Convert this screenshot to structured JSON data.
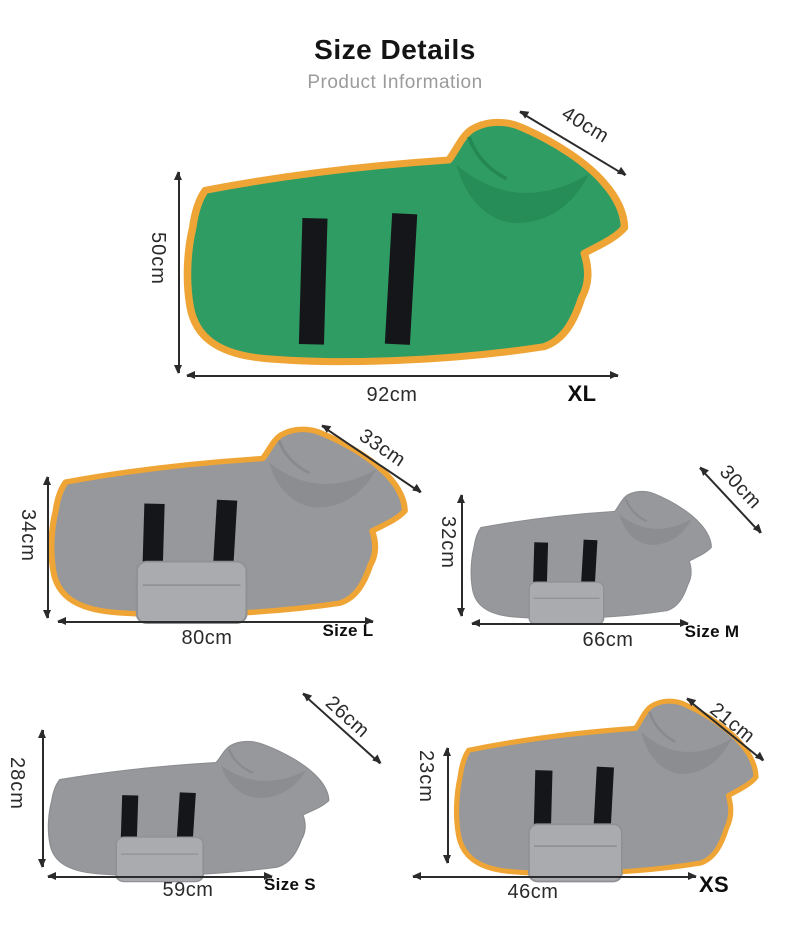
{
  "header": {
    "title": "Size Details",
    "subtitle": "Product Information"
  },
  "sizes": [
    {
      "id": "xl",
      "label": "XL",
      "neck": "40cm",
      "back_height": "50cm",
      "length": "92cm",
      "robe_color": "green",
      "trim": true
    },
    {
      "id": "l",
      "label": "Size L",
      "neck": "33cm",
      "back_height": "34cm",
      "length": "80cm",
      "robe_color": "gray",
      "trim": true
    },
    {
      "id": "m",
      "label": "Size M",
      "neck": "30cm",
      "back_height": "32cm",
      "length": "66cm",
      "robe_color": "gray",
      "trim": false
    },
    {
      "id": "s",
      "label": "Size S",
      "neck": "26cm",
      "back_height": "28cm",
      "length": "59cm",
      "robe_color": "gray",
      "trim": false
    },
    {
      "id": "xs",
      "label": "XS",
      "neck": "21cm",
      "back_height": "23cm",
      "length": "46cm",
      "robe_color": "gray",
      "trim": true
    }
  ],
  "colors": {
    "robe_green": "#2f9c63",
    "robe_gray": "#96989b",
    "trim_orange": "#efa536",
    "strap_black": "#15161a",
    "label_ink": "#2b2b2b",
    "title_ink": "#141414",
    "subtitle_ink": "#9b9b9b"
  }
}
